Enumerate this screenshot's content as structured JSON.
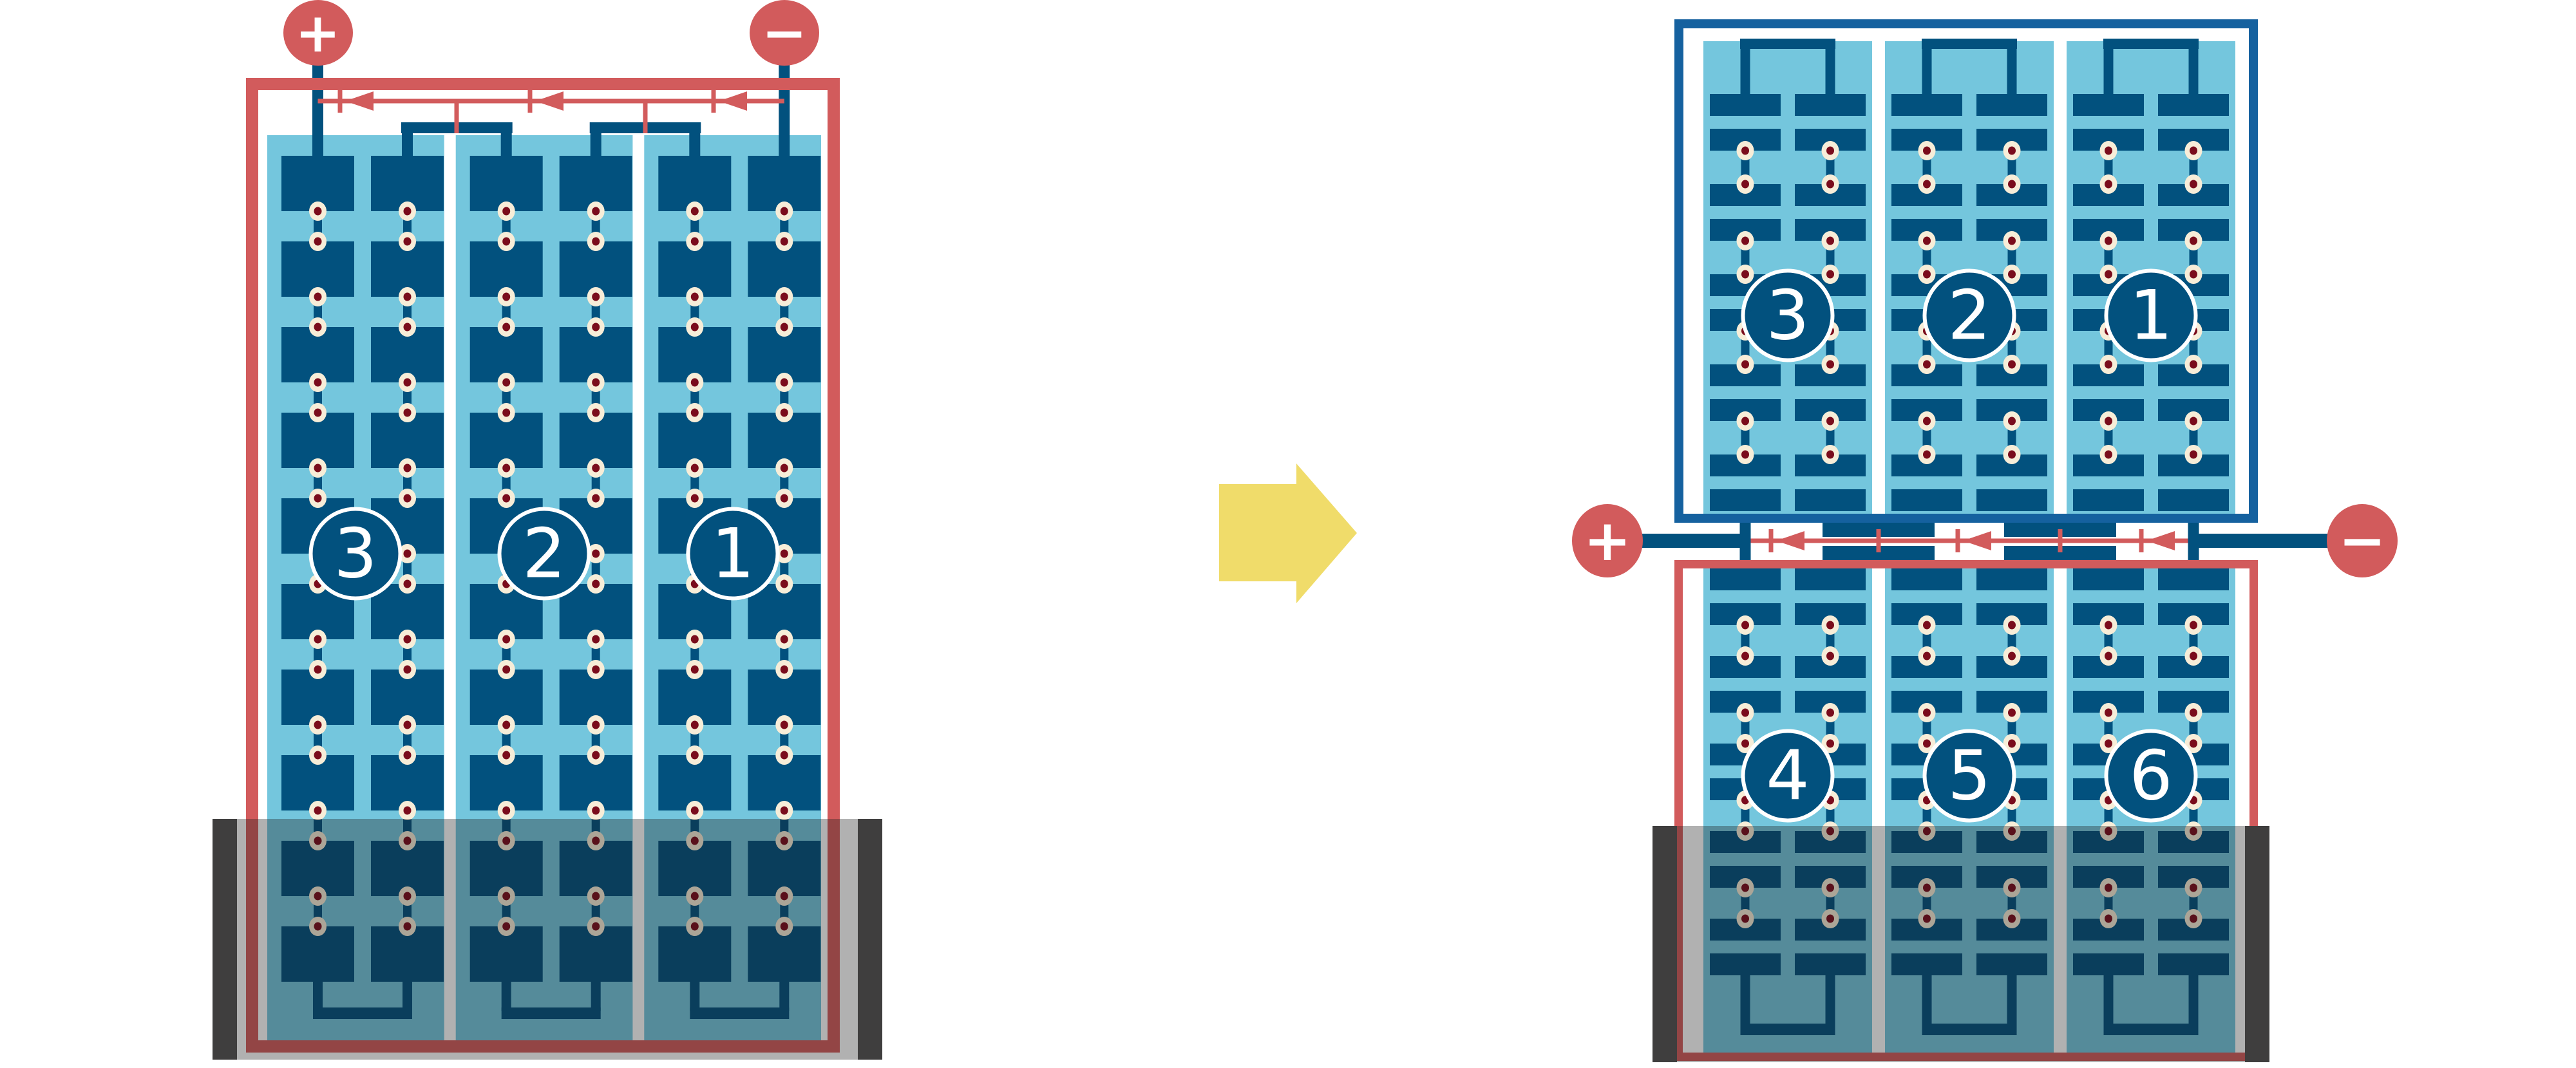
{
  "colors": {
    "red": "#D25B5C",
    "navy": "#02517E",
    "frame_blue": "#15619F",
    "light_blue": "#74C6DD",
    "cream": "#F7EDD8",
    "dot_red": "#7A0C1C",
    "yellow": "#F0DC6A",
    "tray_bar": "#3F3E3E",
    "overlay_tint": "rgba(25,25,25,0.34)",
    "background": "#FFFFFF",
    "label_text": "#FFFFFF"
  },
  "left_battery": {
    "positive_terminal": "+",
    "negative_terminal": "−",
    "cell_labels": [
      "3",
      "2",
      "1"
    ]
  },
  "right_battery": {
    "positive_terminal": "+",
    "negative_terminal": "−",
    "top_unit_cell_labels": [
      "3",
      "2",
      "1"
    ],
    "bottom_unit_cell_labels": [
      "4",
      "5",
      "6"
    ]
  }
}
